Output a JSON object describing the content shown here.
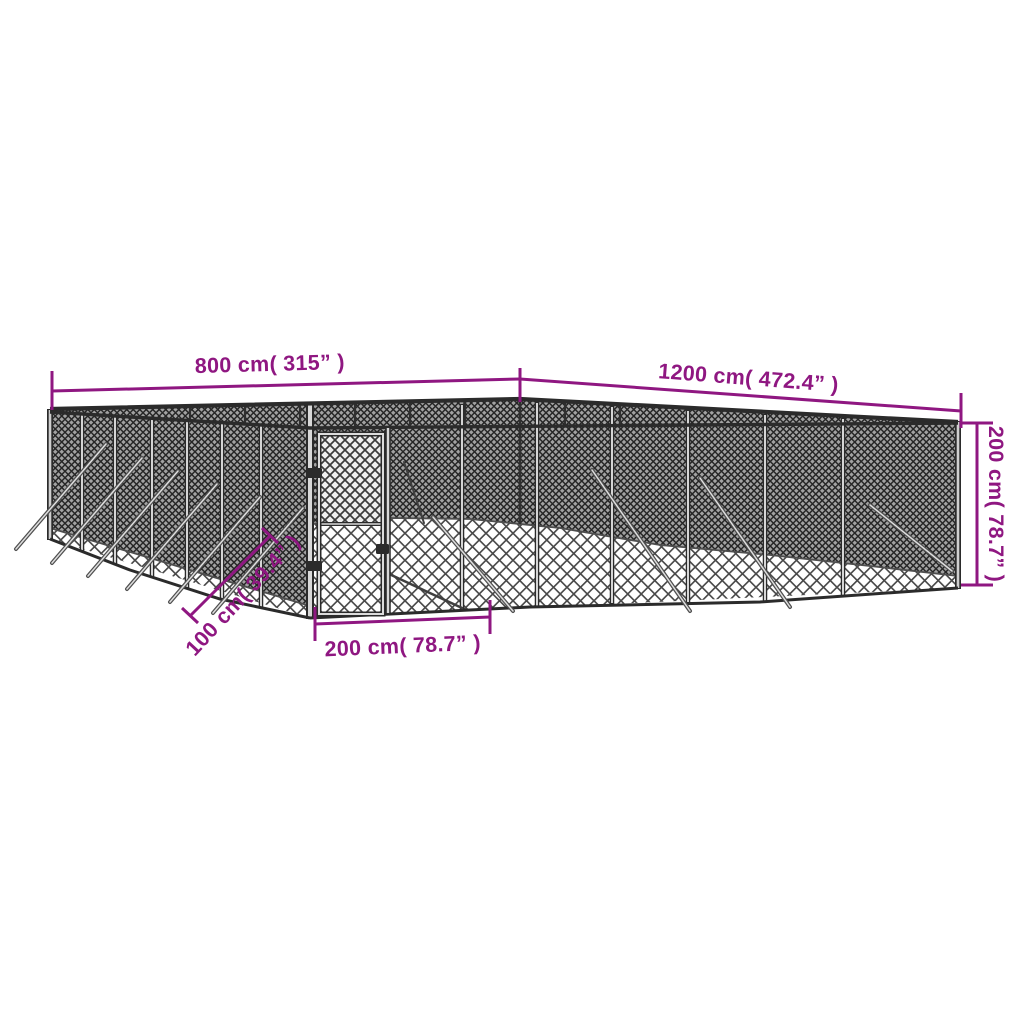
{
  "colors": {
    "dimension_hex": "#8F1781",
    "fence_frame_hex": "#2b2b2b"
  },
  "dimensions": {
    "top_left_length": "800 cm( 315” )",
    "top_right_length": "1200 cm( 472.4” )",
    "right_height": "200 cm( 78.7” )",
    "gate_width": "200 cm( 78.7” )",
    "corner_offset": "100 cm( 39.4” )"
  }
}
